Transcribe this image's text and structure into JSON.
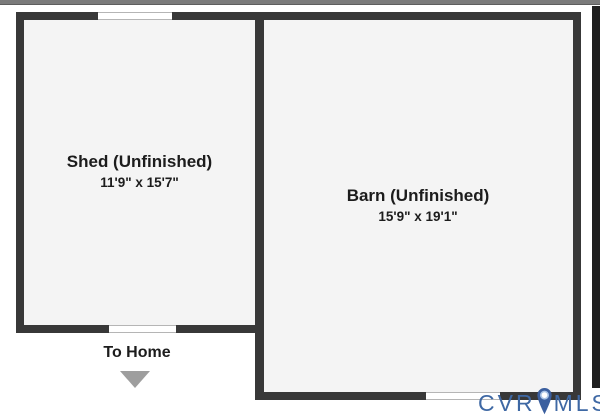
{
  "floorplan": {
    "rooms": [
      {
        "id": "shed",
        "name": "Shed (Unfinished)",
        "dimensions": "11'9\" x 15'7\""
      },
      {
        "id": "barn",
        "name": "Barn (Unfinished)",
        "dimensions": "15'9\" x 19'1\""
      }
    ],
    "annotations": {
      "to_home": "To Home",
      "to_home_direction": "down"
    },
    "openings": [
      {
        "wall": "shed-top",
        "type": "window"
      },
      {
        "wall": "shed-bottom",
        "type": "window"
      },
      {
        "wall": "barn-bottom",
        "type": "window"
      }
    ],
    "colors": {
      "wall": "#383838",
      "room_fill": "#f4f4f4",
      "background": "#ffffff",
      "top_bar": "#7b7b7b",
      "right_strip": "#1f1f1f",
      "arrow": "#9e9e9e",
      "logo_blue": "#3e68a4",
      "pin_blue": "#3b5f9f"
    }
  },
  "logo": {
    "prefix": "CVR",
    "suffix": "MLS",
    "icon": "map-pin-icon"
  }
}
